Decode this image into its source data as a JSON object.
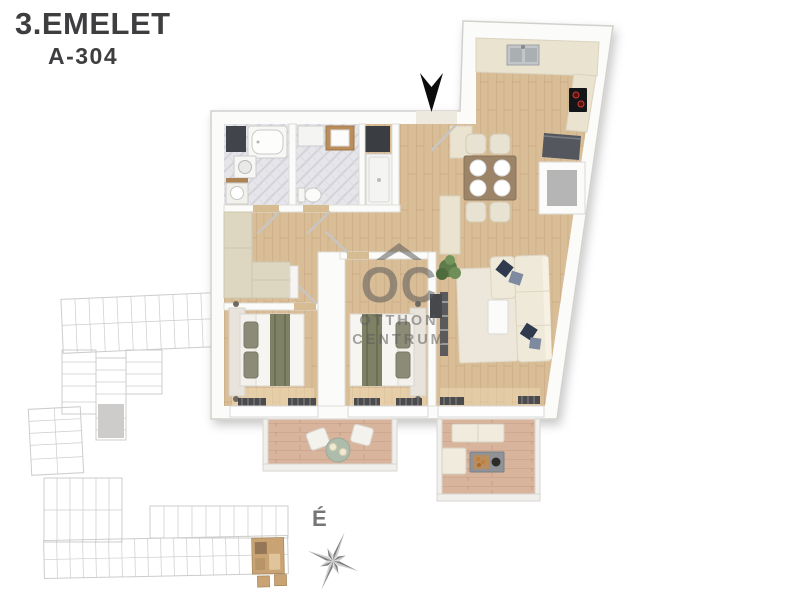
{
  "header": {
    "floor_label": "3.EMELET",
    "unit_label": "A-304"
  },
  "watermark": {
    "initials": "OC",
    "word1": "OTTHON",
    "word2": "CENTRUM"
  },
  "compass": {
    "north_label": "É"
  },
  "theme": {
    "title_color": "#3e3e40",
    "wood": "#d9bd97",
    "deck": "#d9b49d",
    "wall": "#fbfbfa",
    "counter": "#e9e3d0",
    "wardrobe": "#ddd6c0",
    "sofa": "#efe9da",
    "pillow_navy": "#2f3a4e",
    "pillow_slate": "#7e8aa0",
    "runner_olive": "#7f8164",
    "siteplan_line": "#c7c7c7",
    "siteplan_unit_fill": "#c9c6c6",
    "siteplan_highlight": "#c59a66",
    "watermark_color": "#5c5c5c",
    "compass_dark": "#808080",
    "compass_light": "#cdcdcd",
    "arrow_color": "#0c0c0c"
  }
}
